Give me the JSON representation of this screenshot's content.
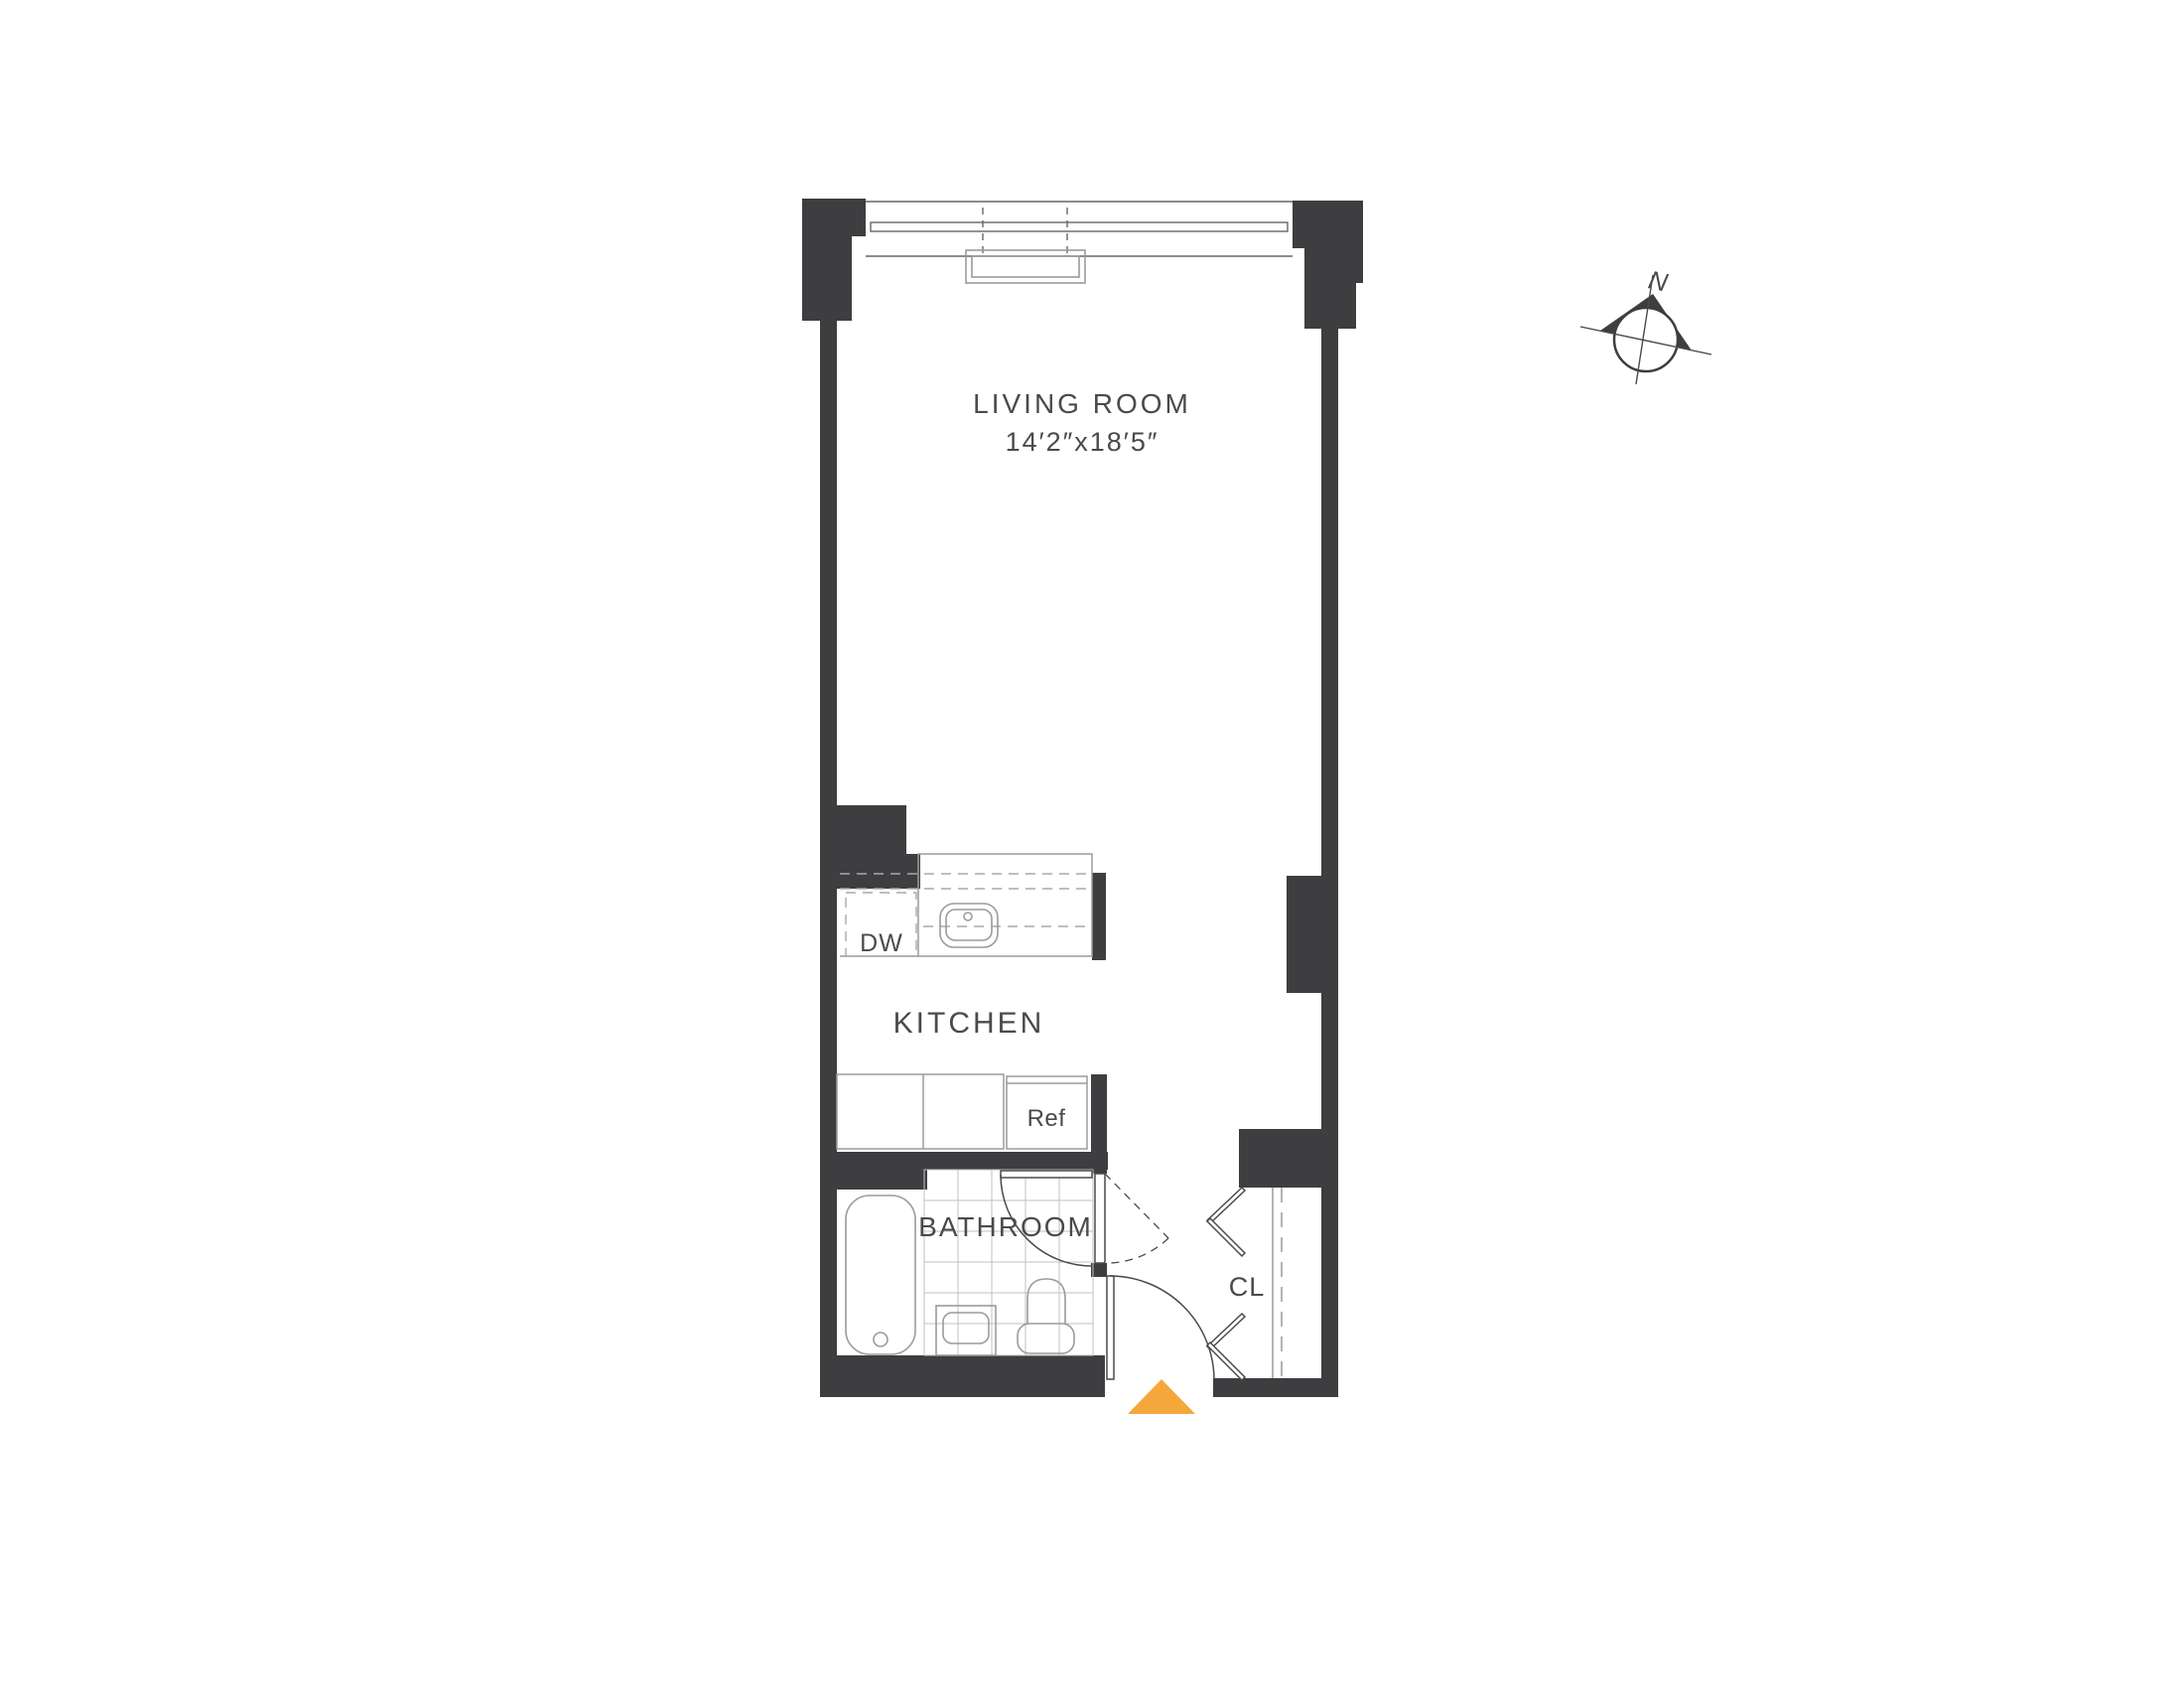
{
  "labels": {
    "living_room": "LIVING ROOM",
    "living_room_dims": "14′2″x18′5″",
    "kitchen": "KITCHEN",
    "bathroom": "BATHROOM",
    "closet": "CL",
    "dishwasher": "DW",
    "refrigerator": "Ref",
    "north": "N"
  },
  "rooms": [
    {
      "name": "LIVING ROOM",
      "dimensions": "14′2″x18′5″"
    },
    {
      "name": "KITCHEN"
    },
    {
      "name": "BATHROOM"
    },
    {
      "name": "CL"
    }
  ],
  "colors": {
    "wall": "#3E3D40",
    "fixture_line": "#9B9B9B",
    "tile_line": "#C2C2C2",
    "door_line": "#4A4A4A",
    "window_line": "#666666",
    "cabinet_line": "#A9A9A9",
    "text": "#4A4A4A",
    "entry_marker": "#F5A73C",
    "background": "#FFFFFF"
  }
}
